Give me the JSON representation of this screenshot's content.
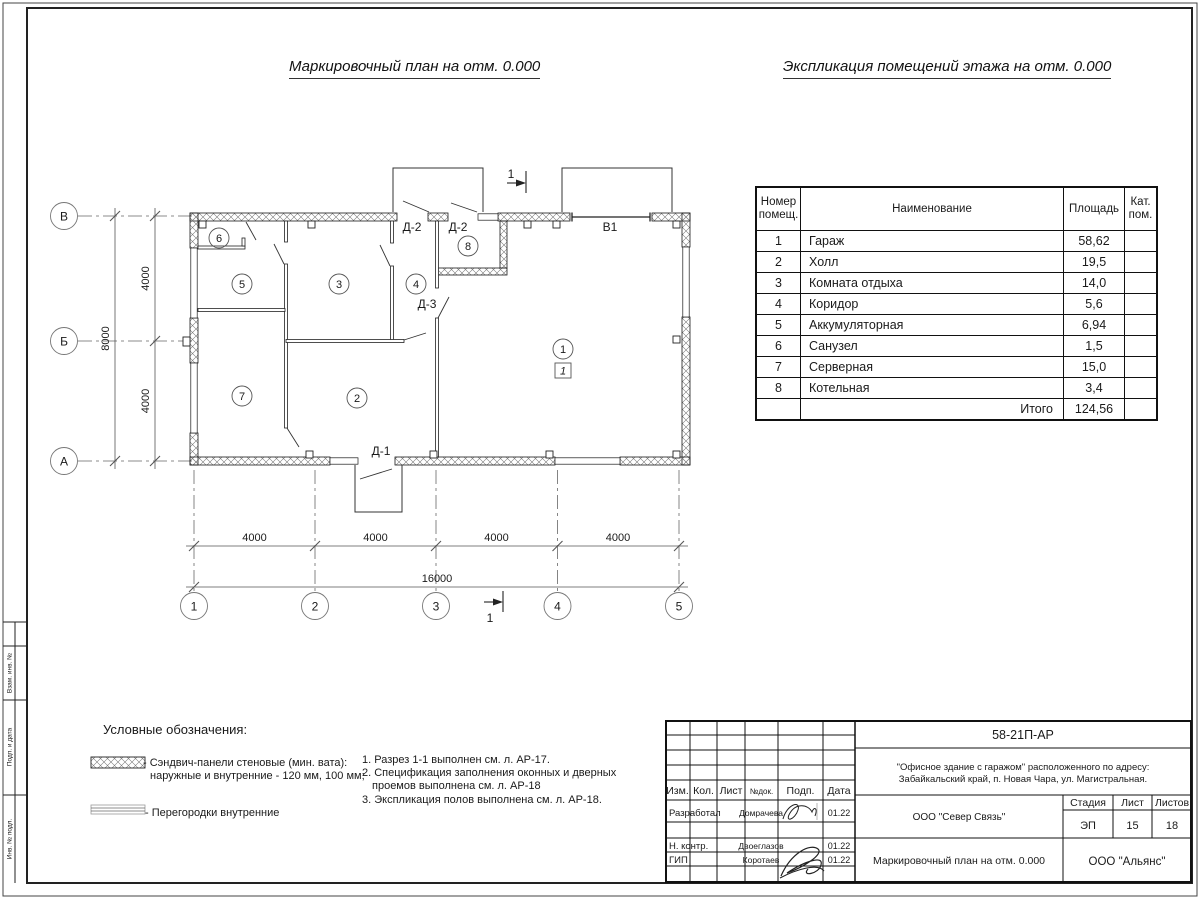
{
  "titles": {
    "plan": "Маркировочный план на отм. 0.000",
    "explication": "Экспликация помещений этажа на отм. 0.000"
  },
  "explication_table": {
    "headers": {
      "num_line1": "Номер",
      "num_line2": "помещ.",
      "name": "Наименование",
      "area": "Площадь",
      "cat_line1": "Кат.",
      "cat_line2": "пом."
    },
    "rows": [
      {
        "num": "1",
        "name": "Гараж",
        "area": "58,62"
      },
      {
        "num": "2",
        "name": "Холл",
        "area": "19,5"
      },
      {
        "num": "3",
        "name": "Комната отдыха",
        "area": "14,0"
      },
      {
        "num": "4",
        "name": "Коридор",
        "area": "5,6"
      },
      {
        "num": "5",
        "name": "Аккумуляторная",
        "area": "6,94"
      },
      {
        "num": "6",
        "name": "Санузел",
        "area": "1,5"
      },
      {
        "num": "7",
        "name": "Серверная",
        "area": "15,0"
      },
      {
        "num": "8",
        "name": "Котельная",
        "area": "3,4"
      }
    ],
    "total_label": "Итого",
    "total_area": "124,56"
  },
  "plan": {
    "axes_rows": [
      "В",
      "Б",
      "А"
    ],
    "axes_cols": [
      "1",
      "2",
      "3",
      "4",
      "5"
    ],
    "dims_bottom": [
      "4000",
      "4000",
      "4000",
      "4000"
    ],
    "dim_bottom_total": "16000",
    "dims_left": [
      "4000",
      "4000"
    ],
    "dim_left_total": "8000",
    "rooms": [
      "1",
      "2",
      "3",
      "4",
      "5",
      "6",
      "7",
      "8"
    ],
    "garage_floor_mark": "1",
    "doors": {
      "d1": "Д-1",
      "d2_left": "Д-2",
      "d2_right": "Д-2",
      "d3": "Д-3",
      "gate": "В1"
    },
    "section_mark": "1"
  },
  "legend": {
    "title": "Условные обозначения:",
    "sandwich_line1": "- Сэндвич-панели стеновые (мин. вата):",
    "sandwich_line2": "наружные и внутренние - 120 мм, 100 мм;",
    "partitions": "- Перегородки внутренние"
  },
  "notes": {
    "line1": "1. Разрез 1-1 выполнен см. л. АР-17.",
    "line2": "2. Спецификация заполнения оконных и дверных",
    "line3": "проемов выполнена см. л. АР-18",
    "line4": "3. Экспликация полов выполнена см. л. АР-18."
  },
  "title_block": {
    "doc_number": "58-21П-АР",
    "object_line1": "\"Офисное здание с гаражом\" расположенного по адресу:",
    "object_line2": "Забайкальский край, п. Новая Чара, ул. Магистральная.",
    "columns": [
      "Изм.",
      "Кол.",
      "Лист",
      "№док.",
      "Подп.",
      "Дата"
    ],
    "rows": [
      {
        "role": "Разработал",
        "name": "Домрачева",
        "date": "01.22"
      },
      {
        "role": "Н. контр.",
        "name": "Двоеглазов",
        "date": "01.22"
      },
      {
        "role": "ГИП",
        "name": "Коротаев",
        "date": "01.22"
      }
    ],
    "organization": "ООО \"Север Связь\"",
    "stage_label": "Стадия",
    "sheet_label": "Лист",
    "sheets_label": "Листов",
    "stage": "ЭП",
    "sheet": "15",
    "sheets": "18",
    "drawing_name": "Маркировочный план на отм. 0.000",
    "company": "ООО \"Альянс\""
  },
  "side_stamp": {
    "labels": [
      "Взам. инв. №",
      "Подп. и дата",
      "Инв. № подл."
    ]
  }
}
